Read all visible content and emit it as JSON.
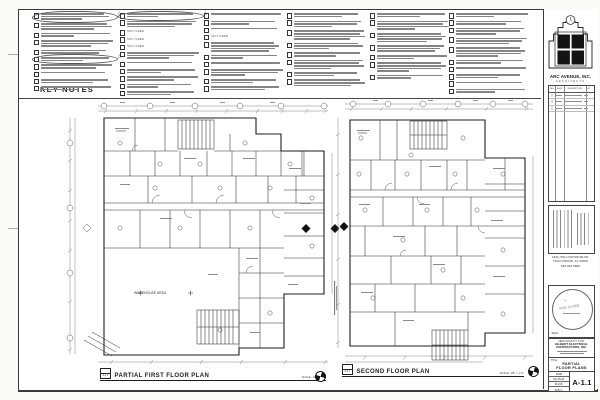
{
  "key_notes": {
    "title": "KEY NOTES",
    "not_used_text": "NOT USED",
    "columns": [
      {
        "x": 34,
        "items": [
          {
            "l": 3,
            "cloud": true
          },
          {
            "l": 3
          },
          {
            "l": 2
          },
          {
            "l": 3
          },
          {
            "l": 2
          },
          {
            "l": 2,
            "cloud": true
          },
          {
            "l": 2
          },
          {
            "l": 1
          },
          {
            "l": 2
          },
          {
            "l": 2
          }
        ]
      },
      {
        "x": 120,
        "items": [
          {
            "l": 2,
            "cloud": true
          },
          {
            "l": 3
          },
          {
            "nu": true
          },
          {
            "nu": true
          },
          {
            "nu": true
          },
          {
            "l": 3
          },
          {
            "l": 1
          },
          {
            "l": 2
          },
          {
            "l": 2
          },
          {
            "l": 2
          },
          {
            "l": 2
          }
        ]
      },
      {
        "x": 204,
        "items": [
          {
            "l": 1
          },
          {
            "l": 2
          },
          {
            "l": 1
          },
          {
            "nu": true
          },
          {
            "l": 4
          },
          {
            "l": 2
          },
          {
            "l": 1
          },
          {
            "l": 3
          },
          {
            "l": 2
          },
          {
            "l": 2
          }
        ]
      },
      {
        "x": 287,
        "items": [
          {
            "l": 2
          },
          {
            "l": 3
          },
          {
            "l": 4
          },
          {
            "l": 3
          },
          {
            "l": 2
          },
          {
            "l": 4
          },
          {
            "l": 2
          },
          {
            "l": 3
          }
        ]
      },
      {
        "x": 370,
        "items": [
          {
            "l": 2
          },
          {
            "l": 4
          },
          {
            "l": 4
          },
          {
            "l": 3
          },
          {
            "l": 2
          },
          {
            "l": 4
          },
          {
            "l": 2
          }
        ]
      },
      {
        "x": 449,
        "items": [
          {
            "l": 2
          },
          {
            "l": 2
          },
          {
            "l": 3
          },
          {
            "l": 3
          },
          {
            "l": 4
          },
          {
            "l": 2
          },
          {
            "l": 1
          },
          {
            "l": 2
          },
          {
            "l": 1
          },
          {
            "l": 2
          }
        ]
      }
    ]
  },
  "plans": [
    {
      "ref": "A-1.1",
      "title": "PARTIAL FIRST FLOOR PLAN",
      "scale": "SCALE: 1/8\" = 1'-0\"",
      "room_label": "WAREHOUSE AREA"
    },
    {
      "ref": "A-1.1",
      "title": "SECOND FLOOR PLAN",
      "scale": "SCALE: 1/8\" = 1'-0\""
    }
  ],
  "title_block": {
    "firm_name": "ARC AVENUE, INC.",
    "firm_subtitle": "ARCHITECTS",
    "revision_headers": [
      "REV",
      "DATE",
      "DESCRIPTION",
      "BY"
    ],
    "revision_row_count": 3,
    "address_line1": "2341 HOLLYWOOD BLVD.",
    "address_line2": "HOLLYWOOD, FL 33020",
    "address_line3": "954.923.5800",
    "seal_label": "SEAL",
    "stamp_date": "AUG 13 2002",
    "project_label": "NEW FACILITY FOR:",
    "project_name_line1": "GILBERT ELECTRICAL",
    "project_name_line2": "CONTRACTORS, INC.",
    "title_label": "TITLE:",
    "sheet_title_line1": "PARTIAL",
    "sheet_title_line2": "FLOOR PLANS",
    "info_rows": [
      "1500",
      "06-15-01",
      "R.D.B.",
      "D.B.C."
    ],
    "sheet_number": "A-1.1"
  }
}
